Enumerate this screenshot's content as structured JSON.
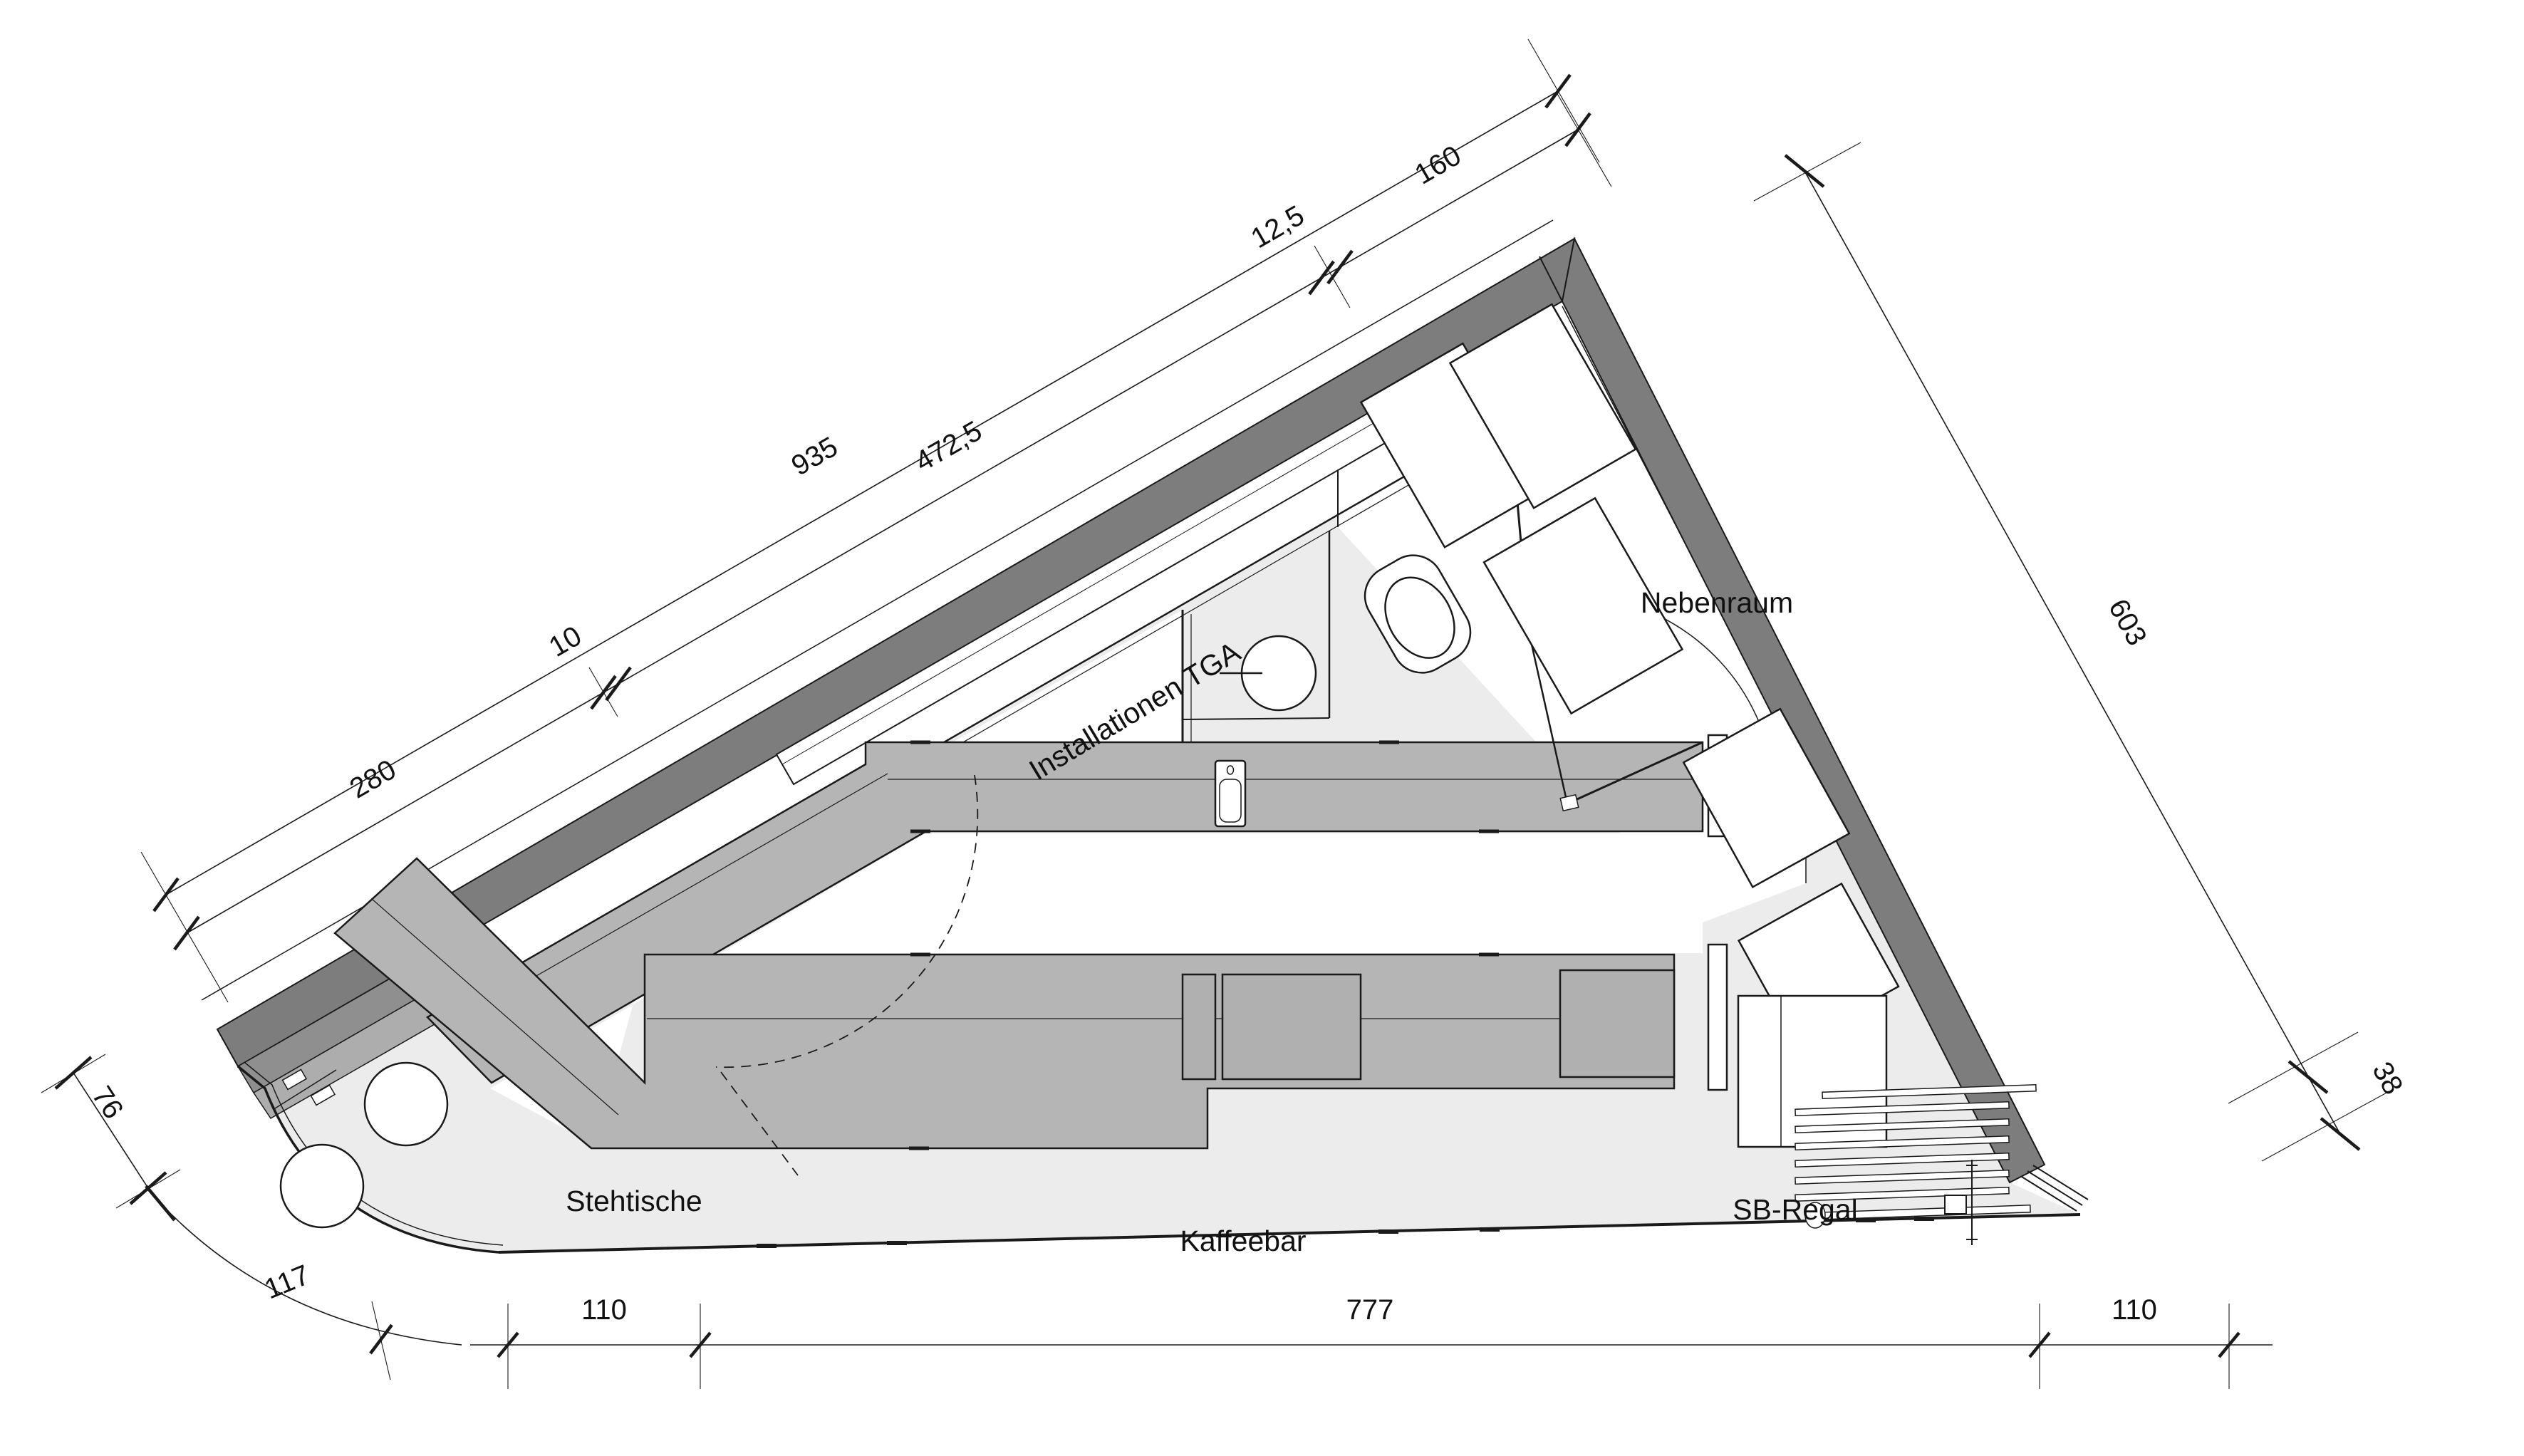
{
  "drawing": {
    "type": "architectural-floor-plan",
    "description": "Triangular cafe floor plan with coffee bar, WC and side room"
  },
  "rooms": {
    "tga": "Installationen TGA",
    "nebenraum": "Nebenraum",
    "stehtische": "Stehtische",
    "kaffeebar": "Kaffeebar",
    "sb_regal": "SB-Regal"
  },
  "dimensions": {
    "facade_total": "935",
    "facade_segments": [
      "280",
      "10",
      "472,5",
      "12,5",
      "160"
    ],
    "right_side": [
      "603",
      "38"
    ],
    "left_side": [
      "76",
      "117"
    ],
    "bottom": [
      "110",
      "777",
      "110"
    ]
  },
  "colors": {
    "wall": "#7d7d7d",
    "wall_step_dark": "#8f8f8f",
    "wall_step_light": "#adadad",
    "counter": "#b5b5b5",
    "floor": "#ececec",
    "line": "#1a1a1a",
    "background": "#ffffff"
  }
}
